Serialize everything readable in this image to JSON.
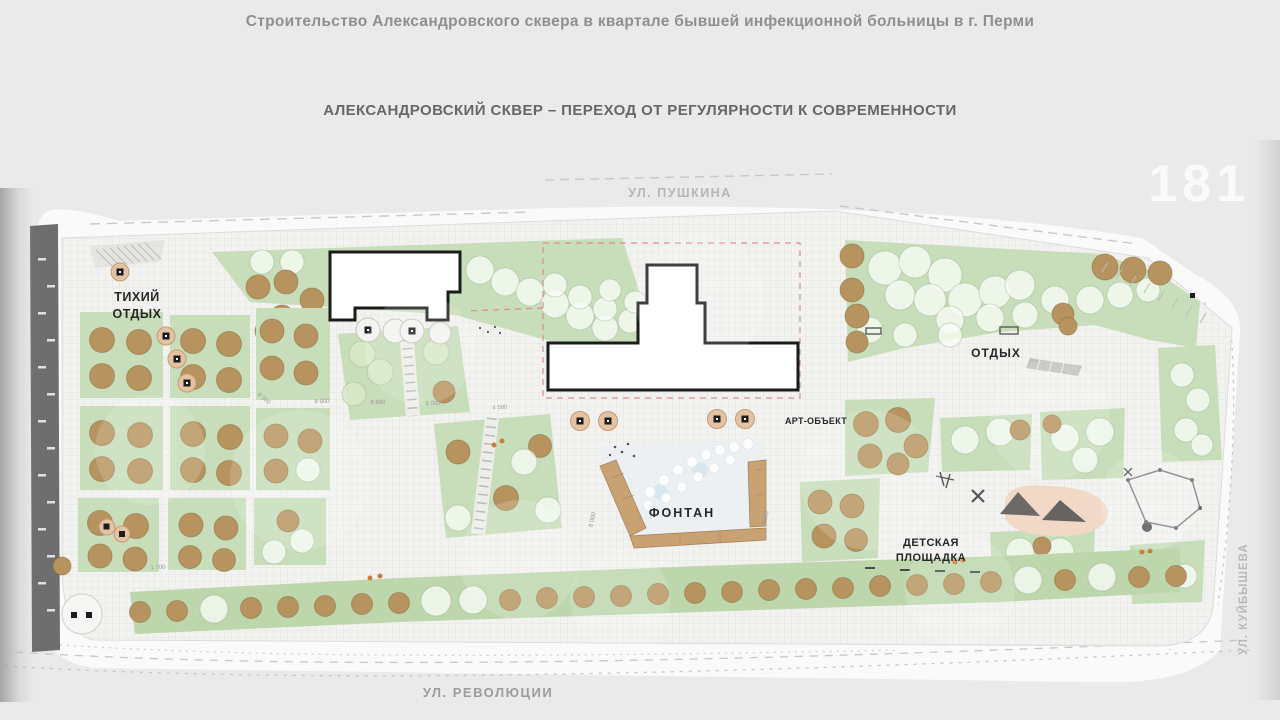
{
  "slide": {
    "title": "Строительство Александровского сквера в квартале бывшей инфекционной больницы в г. Перми",
    "subtitle": "АЛЕКСАНДРОВСКИЙ СКВЕР – ПЕРЕХОД ОТ РЕГУЛЯРНОСТИ К СОВРЕМЕННОСТИ",
    "page_number": "181"
  },
  "streets": {
    "top": "УЛ. ПУШКИНА",
    "bottom": "УЛ. РЕВОЛЮЦИИ",
    "right": "УЛ. КУЙБЫШЕВА"
  },
  "plan": {
    "labels": {
      "quiet_rest_line1": "ТИХИЙ",
      "quiet_rest_line2": "ОТДЫХ",
      "rest": "ОТДЫХ",
      "art_object": "АРТ-ОБЪЕКТ",
      "fountain": "ФОНТАН",
      "playground_line1": "ДЕТСКАЯ",
      "playground_line2": "ПЛОЩАДКА"
    },
    "dimensions": {
      "d1": "8 900",
      "d2": "9 900",
      "d3": "9 000",
      "d4": "4 500",
      "d5": "8 000",
      "d6": "8 095",
      "d7": "1 700",
      "d8": "8 000"
    },
    "colors": {
      "lawn_green": "#c8ddb9",
      "lawn_green_dark": "#bdd6ab",
      "tree_brown": "#b7945f",
      "tree_light": "#f3f7f0",
      "playground_pink": "#f2d8c6",
      "fountain_bench_wood": "#c8a273",
      "road_dark": "#6e6e6e",
      "boundary_red_dash": "#d98f8f",
      "paving_grey": "#f2f2f0"
    }
  }
}
